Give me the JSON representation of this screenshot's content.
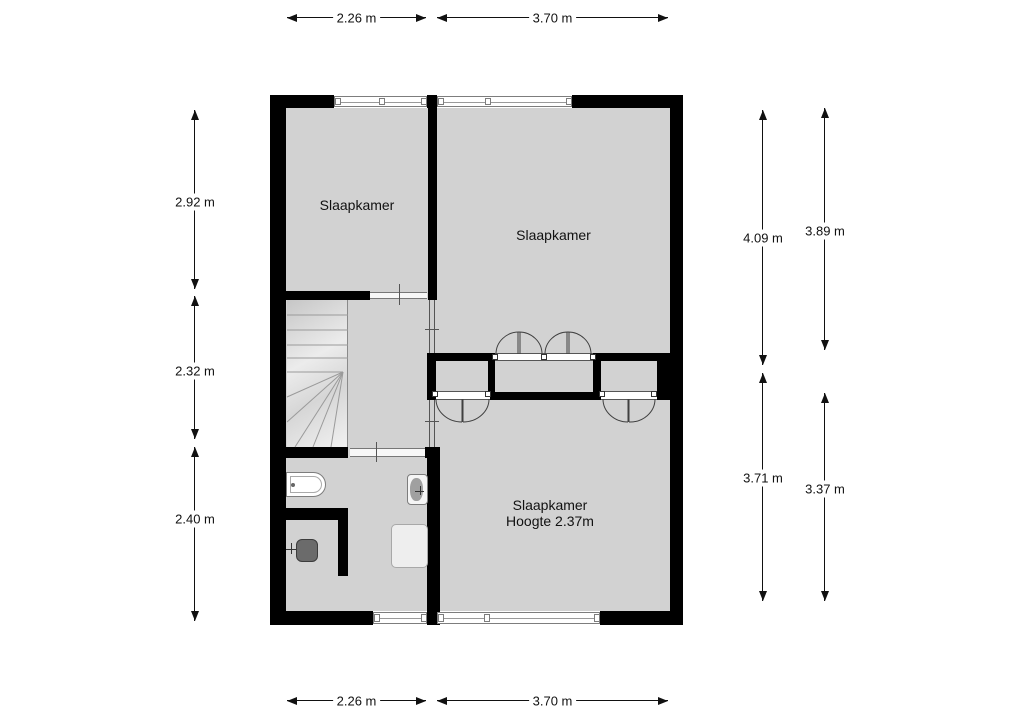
{
  "colors": {
    "background": "#ffffff",
    "floor": "#d2d2d2",
    "wall": "#000000",
    "outline": "#7d7d7d",
    "text": "#111111"
  },
  "rooms": [
    {
      "label": "Slaapkamer"
    },
    {
      "label": "Slaapkamer"
    },
    {
      "label": "Slaapkamer",
      "sublabel": "Hoogte 2.37m"
    }
  ],
  "dimensions": {
    "top": [
      {
        "label": "2.26 m"
      },
      {
        "label": "3.70 m"
      }
    ],
    "bottom": [
      {
        "label": "2.26 m"
      },
      {
        "label": "3.70 m"
      }
    ],
    "left": [
      {
        "label": "2.92 m"
      },
      {
        "label": "2.32 m"
      },
      {
        "label": "2.40 m"
      }
    ],
    "right_inner": [
      {
        "label": "4.09 m"
      },
      {
        "label": "3.71 m"
      }
    ],
    "right_outer": [
      {
        "label": "3.89 m"
      },
      {
        "label": "3.37 m"
      }
    ]
  },
  "fixtures": [
    {
      "icon": "stairs-icon"
    },
    {
      "icon": "bath-icon"
    },
    {
      "icon": "washbasin-icon"
    },
    {
      "icon": "toilet-icon"
    },
    {
      "icon": "shower-icon"
    }
  ]
}
